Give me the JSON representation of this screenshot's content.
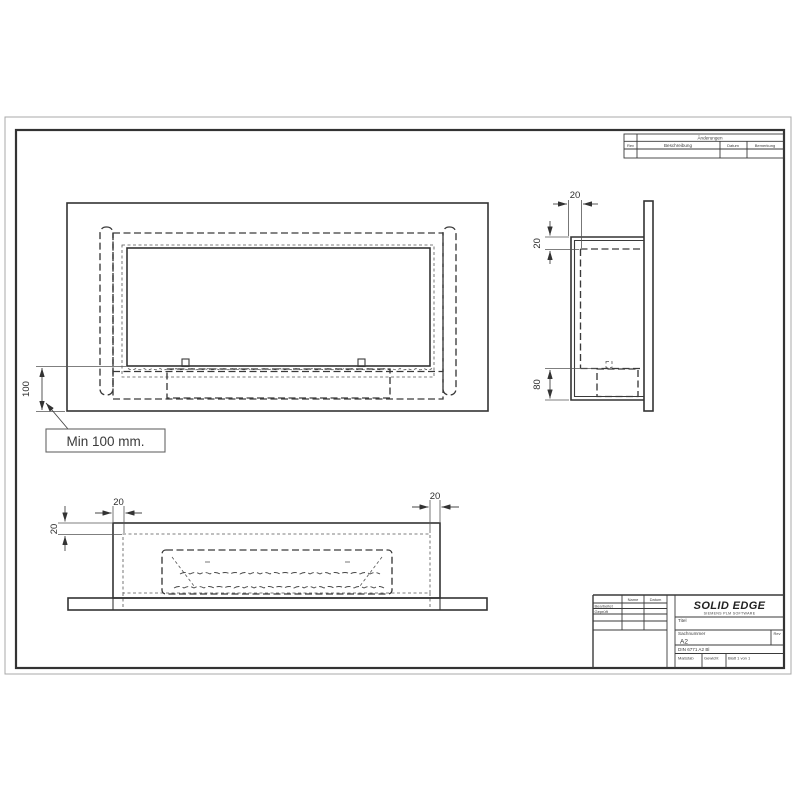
{
  "drawing": {
    "callout": "Min 100 mm.",
    "dims": {
      "front_height": "100",
      "side_top_depth": "20",
      "side_upper_offset": "20",
      "side_lower_height": "80",
      "bottom_left_wall": "20",
      "bottom_right_wall": "20",
      "bottom_side_offset": "20"
    },
    "revision_table": {
      "title": "Änderungen",
      "col_rev": "Rev",
      "col_desc": "Beschreibung",
      "col_date": "Datum",
      "col_note": "Bemerkung"
    },
    "title_block": {
      "col_name": "Name",
      "col_date": "Datum",
      "row_edited": "Bearbeitet",
      "row_checked": "Geprüft",
      "logo": "SOLID EDGE",
      "logo_sub": "SIEMENS PLM SOFTWARE",
      "title_label": "Titel",
      "part_label": "Sachnummer",
      "sheet_size": "A2",
      "rev_label": "Rev",
      "norm_ref": "DIN 6771 A2 Bl",
      "scale_label": "Maßstab",
      "weight_label": "Gewicht",
      "sheet_label": "Blatt 1 von 1"
    },
    "colors": {
      "line": "#333333",
      "paper": "#ffffff"
    }
  }
}
